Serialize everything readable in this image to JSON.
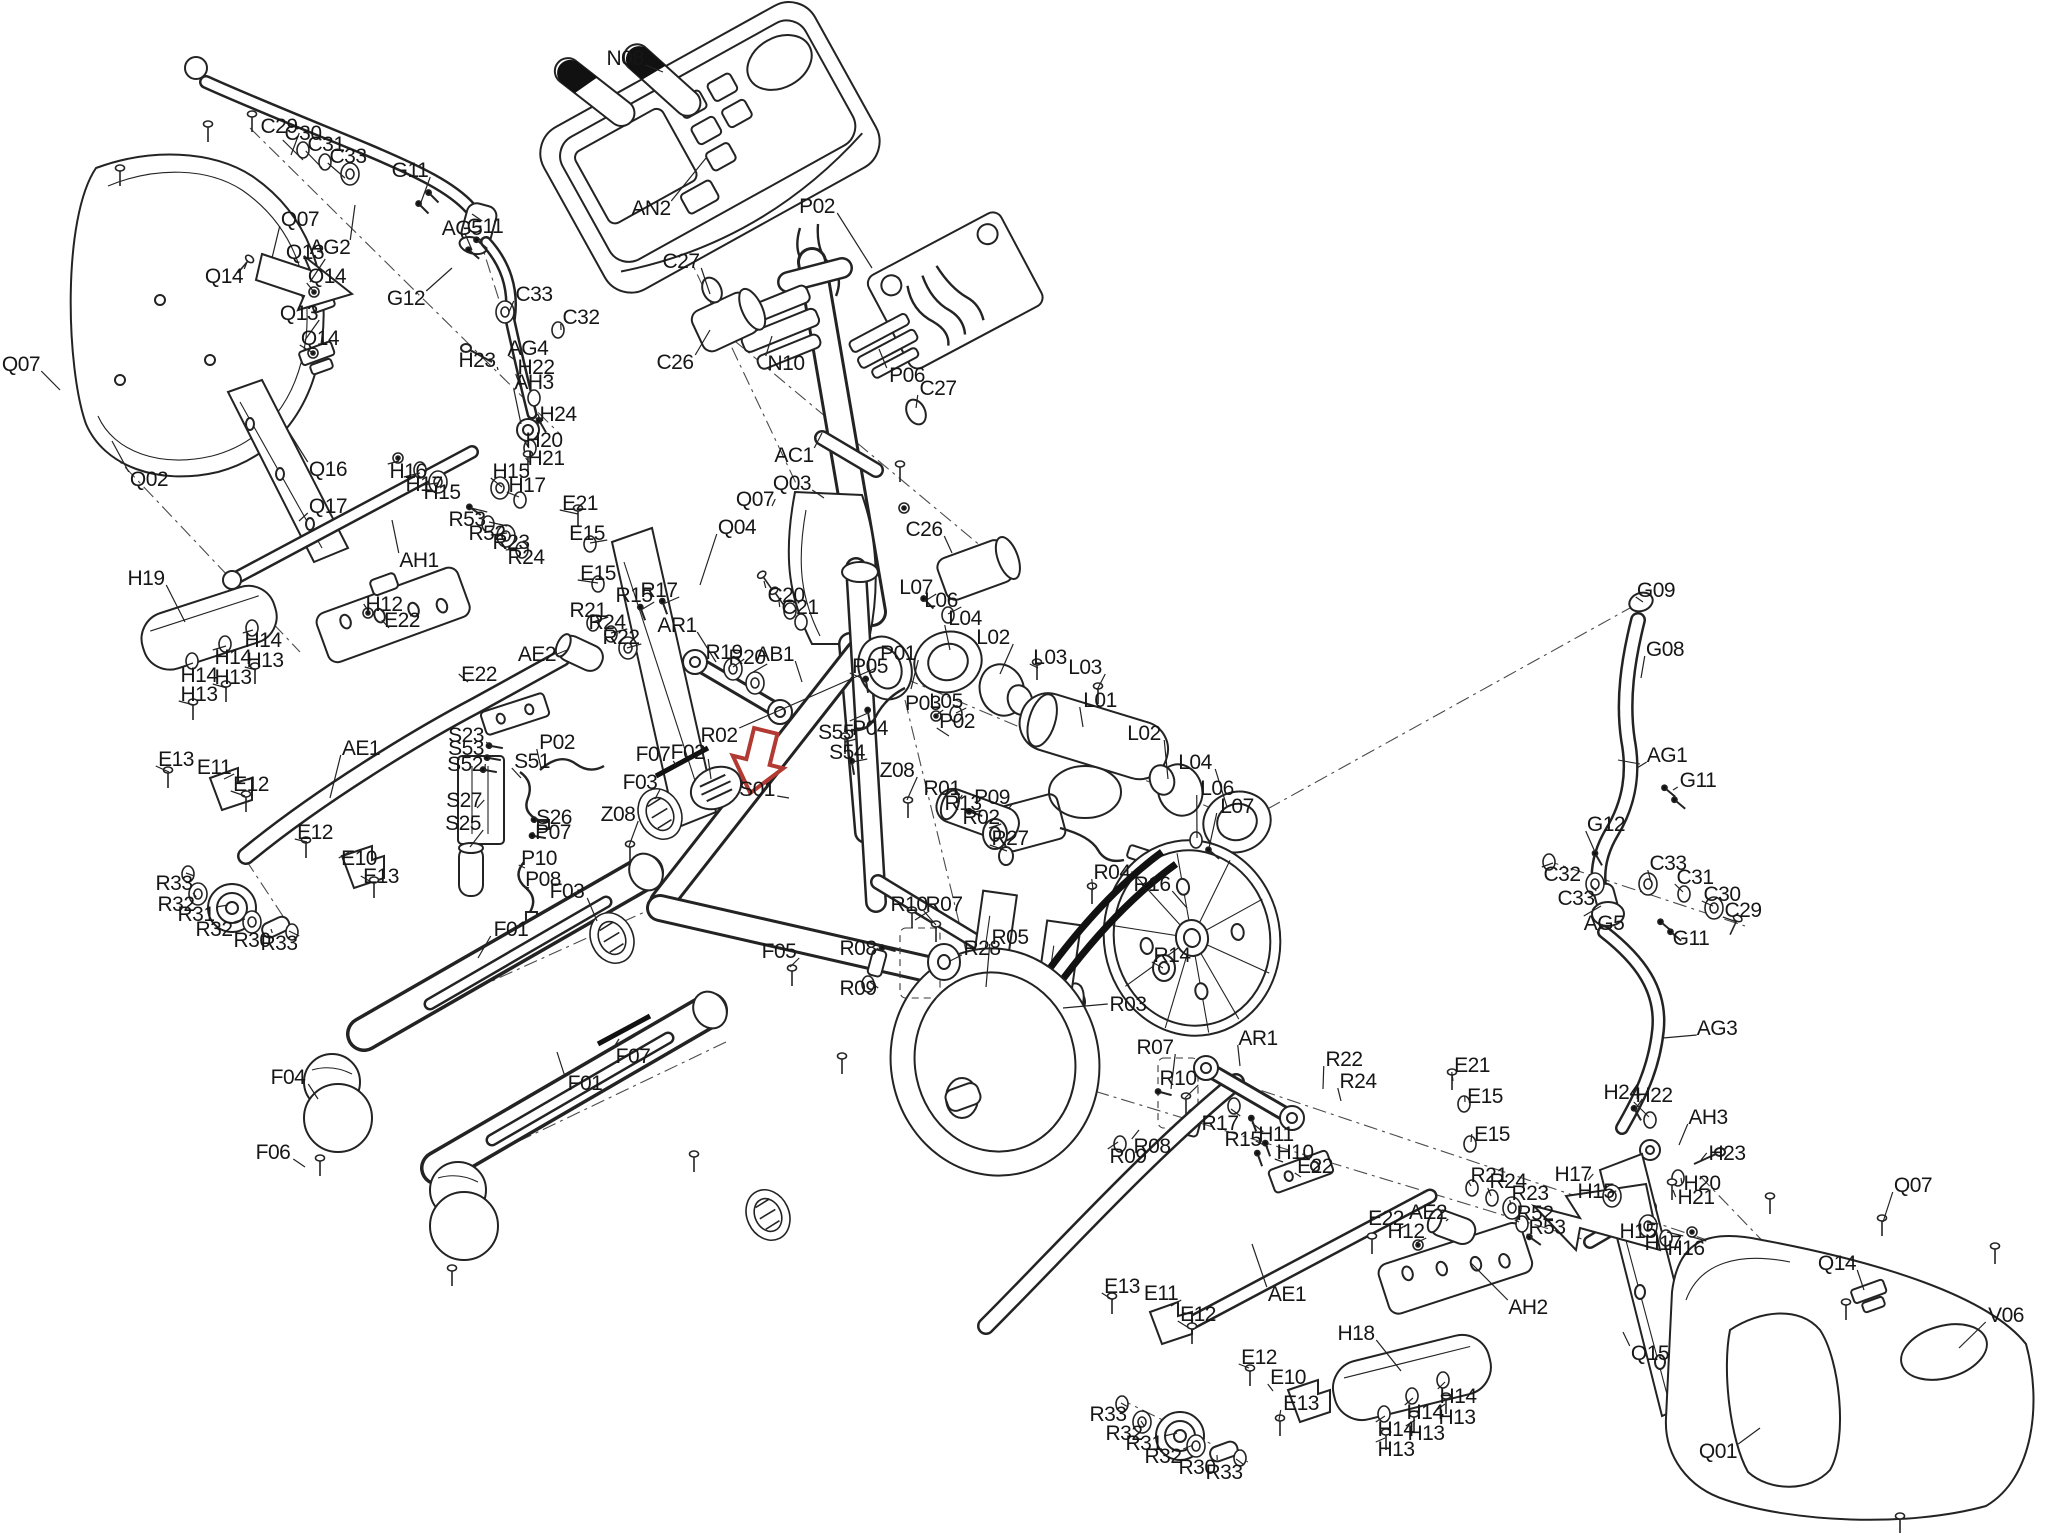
{
  "figure": {
    "kind": "exploded-parts-diagram",
    "subject": "elliptical cross trainer",
    "background": "#ffffff",
    "line_color": "#232323",
    "highlight": {
      "part": "S01",
      "color": "#b23a32",
      "x": 758,
      "y": 763
    }
  },
  "labels": [
    [
      "Q07",
      21,
      364,
      60,
      390
    ],
    [
      "C29",
      279,
      126,
      291,
      155
    ],
    [
      "C30",
      303,
      133,
      303,
      160
    ],
    [
      "C31",
      326,
      144,
      322,
      168
    ],
    [
      "C33",
      348,
      156,
      345,
      178
    ],
    [
      "G11",
      410,
      170,
      420,
      205
    ],
    [
      "Q07",
      300,
      219,
      272,
      258
    ],
    [
      "AG2",
      330,
      247,
      355,
      205
    ],
    [
      "Q13",
      305,
      252,
      310,
      282
    ],
    [
      "Q14",
      224,
      276,
      247,
      262
    ],
    [
      "Q14",
      327,
      276,
      314,
      292
    ],
    [
      "G11",
      485,
      226,
      472,
      250
    ],
    [
      "AG5",
      462,
      228,
      472,
      214
    ],
    [
      "G12",
      406,
      298,
      452,
      268
    ],
    [
      "Q13",
      299,
      313,
      305,
      340
    ],
    [
      "Q14",
      320,
      338,
      313,
      353
    ],
    [
      "H23",
      477,
      360,
      498,
      370
    ],
    [
      "AG4",
      528,
      348,
      515,
      360
    ],
    [
      "H22",
      536,
      367,
      523,
      394
    ],
    [
      "AH3",
      534,
      382,
      521,
      424
    ],
    [
      "H24",
      558,
      414,
      541,
      422
    ],
    [
      "H20",
      544,
      440,
      529,
      448
    ],
    [
      "H21",
      546,
      458,
      529,
      462
    ],
    [
      "C33",
      534,
      294,
      509,
      312
    ],
    [
      "C32",
      581,
      317,
      561,
      330
    ],
    [
      "N08",
      625,
      58,
      663,
      72
    ],
    [
      "AN2",
      651,
      208,
      706,
      158
    ],
    [
      "P02",
      817,
      206,
      872,
      268
    ],
    [
      "C27",
      681,
      261,
      710,
      294
    ],
    [
      "C26",
      675,
      362,
      710,
      330
    ],
    [
      "N10",
      786,
      363,
      772,
      336
    ],
    [
      "P06",
      907,
      375,
      879,
      349
    ],
    [
      "C27",
      938,
      388,
      916,
      408
    ],
    [
      "AC1",
      794,
      455,
      822,
      433
    ],
    [
      "Q03",
      792,
      483,
      824,
      498
    ],
    [
      "Q07",
      755,
      499,
      772,
      506
    ],
    [
      "Q04",
      737,
      527,
      700,
      585
    ],
    [
      "C26",
      924,
      529,
      952,
      553
    ],
    [
      "C20",
      786,
      595,
      764,
      581
    ],
    [
      "C21",
      800,
      607,
      779,
      601
    ],
    [
      "Q02",
      149,
      479,
      112,
      441
    ],
    [
      "Q16",
      328,
      469,
      289,
      432
    ],
    [
      "Q17",
      328,
      506,
      299,
      521
    ],
    [
      "H16",
      408,
      471,
      399,
      461
    ],
    [
      "H17",
      424,
      484,
      420,
      473
    ],
    [
      "H15",
      442,
      492,
      438,
      483
    ],
    [
      "H15",
      511,
      471,
      502,
      487
    ],
    [
      "H17",
      527,
      485,
      519,
      497
    ],
    [
      "R53",
      467,
      519,
      471,
      508
    ],
    [
      "R52",
      487,
      533,
      489,
      522
    ],
    [
      "R23",
      511,
      542,
      507,
      533
    ],
    [
      "R24",
      526,
      557,
      523,
      548
    ],
    [
      "AH1",
      419,
      560,
      392,
      520
    ],
    [
      "E21",
      580,
      503,
      578,
      514
    ],
    [
      "E15",
      587,
      533,
      590,
      543
    ],
    [
      "E15",
      598,
      573,
      598,
      583
    ],
    [
      "H19",
      146,
      578,
      185,
      622
    ],
    [
      "H12",
      384,
      604,
      369,
      612
    ],
    [
      "E22",
      402,
      620,
      389,
      628
    ],
    [
      "H14",
      263,
      640,
      253,
      630
    ],
    [
      "H14",
      233,
      657,
      226,
      646
    ],
    [
      "H13",
      265,
      660,
      256,
      670
    ],
    [
      "H14",
      199,
      675,
      193,
      663
    ],
    [
      "H13",
      233,
      677,
      227,
      688
    ],
    [
      "H13",
      199,
      694,
      194,
      705
    ],
    [
      "E22",
      479,
      674,
      468,
      682
    ],
    [
      "R21",
      588,
      610,
      593,
      622
    ],
    [
      "R24",
      607,
      622,
      611,
      633
    ],
    [
      "R22",
      621,
      637,
      627,
      648
    ],
    [
      "R15",
      634,
      595,
      641,
      610
    ],
    [
      "R17",
      659,
      590,
      663,
      604
    ],
    [
      "AR1",
      677,
      625,
      716,
      662
    ],
    [
      "AE2",
      537,
      654,
      567,
      650
    ],
    [
      "AE1",
      361,
      748,
      330,
      798
    ],
    [
      "E13",
      176,
      759,
      169,
      772
    ],
    [
      "E11",
      214,
      767,
      224,
      779
    ],
    [
      "E12",
      251,
      784,
      245,
      796
    ],
    [
      "E12",
      315,
      832,
      307,
      842
    ],
    [
      "E10",
      359,
      858,
      349,
      852
    ],
    [
      "E13",
      381,
      876,
      373,
      883
    ],
    [
      "R33",
      174,
      883,
      186,
      873
    ],
    [
      "R32",
      176,
      904,
      193,
      893
    ],
    [
      "R31",
      196,
      914,
      228,
      905
    ],
    [
      "R32",
      214,
      929,
      245,
      919
    ],
    [
      "R30",
      252,
      940,
      271,
      929
    ],
    [
      "R33",
      279,
      943,
      289,
      931
    ],
    [
      "S23",
      466,
      735,
      491,
      747
    ],
    [
      "S53",
      466,
      748,
      489,
      758
    ],
    [
      "S52",
      465,
      764,
      485,
      770
    ],
    [
      "P02",
      557,
      742,
      541,
      768
    ],
    [
      "S51",
      532,
      761,
      521,
      778
    ],
    [
      "S27",
      464,
      800,
      477,
      808
    ],
    [
      "S26",
      554,
      817,
      537,
      820
    ],
    [
      "P07",
      553,
      832,
      535,
      836
    ],
    [
      "S25",
      463,
      823,
      470,
      847
    ],
    [
      "P10",
      539,
      858,
      525,
      868
    ],
    [
      "P08",
      543,
      879,
      529,
      888
    ],
    [
      "R19",
      724,
      652,
      733,
      667
    ],
    [
      "R20",
      747,
      657,
      753,
      672
    ],
    [
      "AB1",
      775,
      654,
      802,
      682
    ],
    [
      "P05",
      870,
      666,
      866,
      680
    ],
    [
      "P01",
      898,
      653,
      911,
      689
    ],
    [
      "L07",
      916,
      587,
      925,
      601
    ],
    [
      "L06",
      941,
      600,
      948,
      614
    ],
    [
      "L04",
      965,
      618,
      950,
      650
    ],
    [
      "L02",
      993,
      637,
      1000,
      674
    ],
    [
      "L03",
      1050,
      657,
      1038,
      668
    ],
    [
      "L03",
      1085,
      667,
      1097,
      690
    ],
    [
      "L01",
      1100,
      700,
      1083,
      727
    ],
    [
      "P03",
      923,
      703,
      936,
      715
    ],
    [
      "L05",
      946,
      701,
      956,
      713
    ],
    [
      "P04",
      870,
      728,
      868,
      713
    ],
    [
      "P02",
      957,
      721,
      949,
      736
    ],
    [
      "S55",
      836,
      732,
      845,
      742
    ],
    [
      "S54",
      847,
      752,
      852,
      762
    ],
    [
      "Z08",
      618,
      814,
      629,
      846
    ],
    [
      "Z08",
      897,
      770,
      907,
      800
    ],
    [
      "R01",
      942,
      788,
      957,
      803
    ],
    [
      "R13",
      963,
      803,
      971,
      813
    ],
    [
      "R02",
      981,
      817,
      989,
      828
    ],
    [
      "R02",
      719,
      735,
      876,
      668
    ],
    [
      "P09",
      992,
      797,
      1009,
      808
    ],
    [
      "R27",
      1010,
      838,
      1007,
      851
    ],
    [
      "L02",
      1144,
      733,
      1168,
      779
    ],
    [
      "L04",
      1195,
      762,
      1227,
      807
    ],
    [
      "L06",
      1217,
      788,
      1197,
      838
    ],
    [
      "L07",
      1237,
      806,
      1209,
      848
    ],
    [
      "F07",
      653,
      754,
      676,
      765
    ],
    [
      "F02",
      688,
      752,
      711,
      779
    ],
    [
      "F03",
      640,
      782,
      655,
      799
    ],
    [
      "F03",
      567,
      891,
      597,
      921
    ],
    [
      "S01",
      757,
      789,
      789,
      798
    ],
    [
      "F01",
      511,
      929,
      478,
      958
    ],
    [
      "F05",
      779,
      951,
      790,
      967
    ],
    [
      "F04",
      288,
      1077,
      318,
      1099
    ],
    [
      "F06",
      273,
      1152,
      305,
      1167
    ],
    [
      "F01",
      585,
      1083,
      557,
      1052
    ],
    [
      "F07",
      633,
      1056,
      619,
      1039
    ],
    [
      "R04",
      1112,
      872,
      1093,
      890
    ],
    [
      "R16",
      1152,
      884,
      1187,
      908
    ],
    [
      "R10",
      909,
      904,
      915,
      920
    ],
    [
      "R07",
      944,
      904,
      936,
      925
    ],
    [
      "R08",
      858,
      948,
      872,
      955
    ],
    [
      "R09",
      858,
      988,
      870,
      982
    ],
    [
      "R28",
      982,
      948,
      950,
      961
    ],
    [
      "R05",
      1010,
      937,
      986,
      987
    ],
    [
      "R14",
      1172,
      955,
      1163,
      968
    ],
    [
      "R03",
      1128,
      1004,
      1063,
      1008
    ],
    [
      "R07",
      1155,
      1047,
      1171,
      1089
    ],
    [
      "R10",
      1178,
      1078,
      1185,
      1098
    ],
    [
      "R08",
      1152,
      1146,
      1139,
      1130
    ],
    [
      "R09",
      1128,
      1156,
      1118,
      1142
    ],
    [
      "G09",
      1656,
      590,
      1643,
      602
    ],
    [
      "G08",
      1665,
      649,
      1641,
      678
    ],
    [
      "AG1",
      1667,
      755,
      1637,
      768
    ],
    [
      "G11",
      1698,
      780,
      1673,
      790
    ],
    [
      "G12",
      1606,
      824,
      1595,
      852
    ],
    [
      "C32",
      1562,
      874,
      1553,
      863
    ],
    [
      "C33",
      1576,
      898,
      1591,
      885
    ],
    [
      "C33",
      1668,
      863,
      1651,
      882
    ],
    [
      "C31",
      1695,
      877,
      1683,
      892
    ],
    [
      "C30",
      1722,
      894,
      1713,
      906
    ],
    [
      "C29",
      1743,
      910,
      1737,
      922
    ],
    [
      "AG5",
      1604,
      923,
      1601,
      906
    ],
    [
      "G11",
      1691,
      938,
      1669,
      928
    ],
    [
      "AG3",
      1717,
      1028,
      1663,
      1038
    ],
    [
      "H24",
      1622,
      1092,
      1635,
      1110
    ],
    [
      "H22",
      1654,
      1095,
      1649,
      1117
    ],
    [
      "AH3",
      1708,
      1117,
      1679,
      1145
    ],
    [
      "H23",
      1727,
      1153,
      1701,
      1160
    ],
    [
      "H20",
      1702,
      1183,
      1681,
      1178
    ],
    [
      "H21",
      1696,
      1197,
      1673,
      1190
    ],
    [
      "H17",
      1573,
      1174,
      1588,
      1180
    ],
    [
      "H15",
      1596,
      1191,
      1608,
      1193
    ],
    [
      "H15",
      1638,
      1231,
      1647,
      1222
    ],
    [
      "H17",
      1663,
      1243,
      1667,
      1232
    ],
    [
      "H16",
      1686,
      1248,
      1689,
      1236
    ],
    [
      "AR1",
      1258,
      1038,
      1240,
      1066
    ],
    [
      "R22",
      1344,
      1059,
      1323,
      1089
    ],
    [
      "R24",
      1358,
      1081,
      1341,
      1101
    ],
    [
      "E21",
      1472,
      1065,
      1453,
      1081
    ],
    [
      "E15",
      1485,
      1096,
      1465,
      1102
    ],
    [
      "R17",
      1220,
      1123,
      1231,
      1109
    ],
    [
      "R15",
      1243,
      1139,
      1252,
      1123
    ],
    [
      "H11",
      1276,
      1134,
      1268,
      1147
    ],
    [
      "H10",
      1295,
      1152,
      1283,
      1162
    ],
    [
      "E22",
      1315,
      1166,
      1301,
      1177
    ],
    [
      "E15",
      1492,
      1134,
      1471,
      1142
    ],
    [
      "R21",
      1489,
      1175,
      1471,
      1186
    ],
    [
      "R24",
      1508,
      1181,
      1491,
      1196
    ],
    [
      "R23",
      1530,
      1193,
      1511,
      1205
    ],
    [
      "R52",
      1535,
      1213,
      1519,
      1222
    ],
    [
      "R53",
      1547,
      1227,
      1531,
      1237
    ],
    [
      "AE2",
      1428,
      1212,
      1446,
      1221
    ],
    [
      "E22",
      1386,
      1218,
      1398,
      1230
    ],
    [
      "H12",
      1406,
      1231,
      1416,
      1243
    ],
    [
      "AE1",
      1287,
      1294,
      1252,
      1244
    ],
    [
      "AH2",
      1528,
      1307,
      1470,
      1262
    ],
    [
      "H18",
      1356,
      1333,
      1401,
      1371
    ],
    [
      "E12",
      1198,
      1314,
      1189,
      1328
    ],
    [
      "E13",
      1122,
      1286,
      1113,
      1300
    ],
    [
      "E11",
      1161,
      1293,
      1171,
      1306
    ],
    [
      "E12",
      1259,
      1357,
      1249,
      1368
    ],
    [
      "E10",
      1288,
      1377,
      1273,
      1391
    ],
    [
      "E13",
      1301,
      1403,
      1279,
      1420
    ],
    [
      "R33",
      1108,
      1414,
      1121,
      1403
    ],
    [
      "R32",
      1124,
      1433,
      1141,
      1421
    ],
    [
      "R31",
      1144,
      1443,
      1177,
      1433
    ],
    [
      "R32",
      1163,
      1456,
      1193,
      1445
    ],
    [
      "R30",
      1197,
      1467,
      1217,
      1455
    ],
    [
      "R33",
      1224,
      1472,
      1236,
      1459
    ],
    [
      "H14",
      1458,
      1396,
      1445,
      1382
    ],
    [
      "H13",
      1457,
      1417,
      1445,
      1404
    ],
    [
      "H14",
      1425,
      1412,
      1413,
      1398
    ],
    [
      "H13",
      1426,
      1433,
      1415,
      1420
    ],
    [
      "H14",
      1396,
      1429,
      1385,
      1416
    ],
    [
      "H13",
      1396,
      1449,
      1385,
      1438
    ],
    [
      "Q07",
      1913,
      1185,
      1883,
      1222
    ],
    [
      "Q14",
      1837,
      1263,
      1864,
      1290
    ],
    [
      "V06",
      2006,
      1315,
      1959,
      1348
    ],
    [
      "Q15",
      1650,
      1353,
      1623,
      1332
    ],
    [
      "Q01",
      1718,
      1451,
      1760,
      1428
    ]
  ]
}
